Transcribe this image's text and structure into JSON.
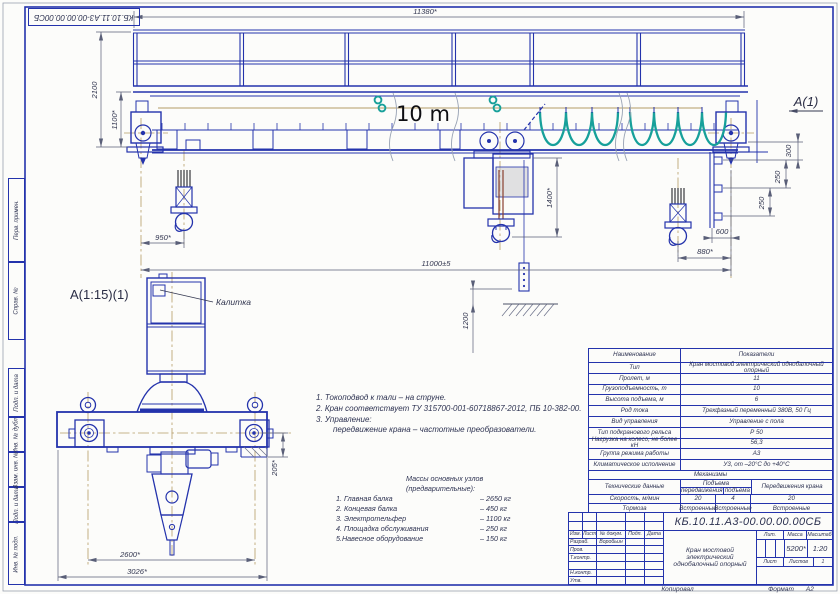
{
  "stamp": {
    "doc_number_top": "КБ.10.11.А3-00.00.00.00СБ"
  },
  "margin": {
    "perv_primen": "Перв. примен.",
    "sprav_no": "Справ. №",
    "podp_data_1": "Подп. и дата",
    "inv_dubl": "Инв. № дубл.",
    "vzam_inv": "Взам. инв. №",
    "podp_data_2": "Подп. и дата",
    "inv_podl": "Инв. № подл."
  },
  "annotations": {
    "span_note": "10 m",
    "view_label": "А(1)",
    "detail_label": "А(1:15)(1)",
    "gate_callout": "Калитка"
  },
  "dims": {
    "top_length": "11380*",
    "total_height": "2100",
    "girder_height": "1100*",
    "hoist_drop": "1400*",
    "left_hook": "950*",
    "span": "11000±5",
    "pendant_height": "1200",
    "step_300": "300",
    "step_250a": "250",
    "step_250b": "250",
    "gauge_600": "600",
    "right_hook": "880*",
    "detail_height": "205*",
    "wheel_base": "2600*",
    "overall_width": "3026*"
  },
  "notes": {
    "line1": "1. Токоподвод к тали – на струне.",
    "line2": "2. Кран соответствует ТУ 315700-001-60718867-2012, ПБ 10-382-00.",
    "line3": "3. Управление:",
    "line4": "передвижение крана – частотные преобразователи."
  },
  "masses": {
    "title": "Массы основных узлов (предварительные):",
    "items": [
      {
        "name": "1. Главная балка",
        "value": "–  2650 кг"
      },
      {
        "name": "2. Концевая балка",
        "value": "–  450 кг"
      },
      {
        "name": "3. Электротельфер",
        "value": "–  1100 кг"
      },
      {
        "name": "4. Площадка  обслуживания",
        "value": "–  250 кг"
      },
      {
        "name": "5.Навесное оборудование",
        "value": "–  150 кг"
      }
    ]
  },
  "spec": {
    "header": {
      "name": "Наименование",
      "value": "Показатели"
    },
    "rows": [
      {
        "name": "Тип",
        "value": "Кран мостовой электрический однобалочный опорный"
      },
      {
        "name": "Пролет, м",
        "value": "11"
      },
      {
        "name": "Грузоподъемность, т",
        "value": "10"
      },
      {
        "name": "Высота подъема, м",
        "value": "6"
      },
      {
        "name": "Род тока",
        "value": "Трехфазный переменный 380В, 50 Гц"
      },
      {
        "name": "Вид управления",
        "value": "Управление с пола"
      },
      {
        "name": "Тип подкранового рельса",
        "value": "Р 50"
      },
      {
        "name": "Нагрузка на колесо, не более кН",
        "value": "56,3"
      },
      {
        "name": "Группа режима работы",
        "value": "А3"
      },
      {
        "name": "Климатическое исполнение",
        "value": "У3, от –20°С до +40°С"
      }
    ],
    "mech": {
      "section": "Механизмы",
      "tech": "Технические данные",
      "group": "Подъема",
      "sub_move": "передвижения",
      "sub_lift": "подъема",
      "crane": "Передвижения крана",
      "speed": {
        "label": "Скорость, м/мин",
        "move": "20",
        "lift": "4",
        "crane": "20"
      },
      "brakes": {
        "label": "Тормоза",
        "move": "Встроенные",
        "lift": "Встроенные",
        "crane": "Встроенные"
      }
    }
  },
  "title_block": {
    "doc_number": "КБ.10.11.А3-00.00.00.00СБ",
    "product_title": "Кран мостовой электрический однобалочный опорный",
    "cols": {
      "izm": "Изм.",
      "list": "Лист",
      "doc": "№ докум.",
      "podp": "Подп.",
      "data": "Дата"
    },
    "rows": {
      "razrab": "Разраб.",
      "razrab_name": "Воробьин",
      "prov": "Пров.",
      "tkontr": "Т.контр.",
      "nkontr": "Н.контр.",
      "utv": "Утв."
    },
    "right": {
      "lit": "Лит.",
      "mass": "Масса",
      "scale": "Масштаб",
      "mass_value": "5200*",
      "scale_value": "1:20",
      "sheet": "Лист",
      "sheets": "Листов",
      "sheets_value": "1"
    },
    "footer": {
      "copied": "Копировал",
      "format": "Формат",
      "format_value": "А2"
    }
  },
  "colors": {
    "line_blue": "#2433ac",
    "festoon_teal": "#17a09a",
    "centerline_tan": "#b49b66",
    "dim_gray": "#5a5f78"
  }
}
